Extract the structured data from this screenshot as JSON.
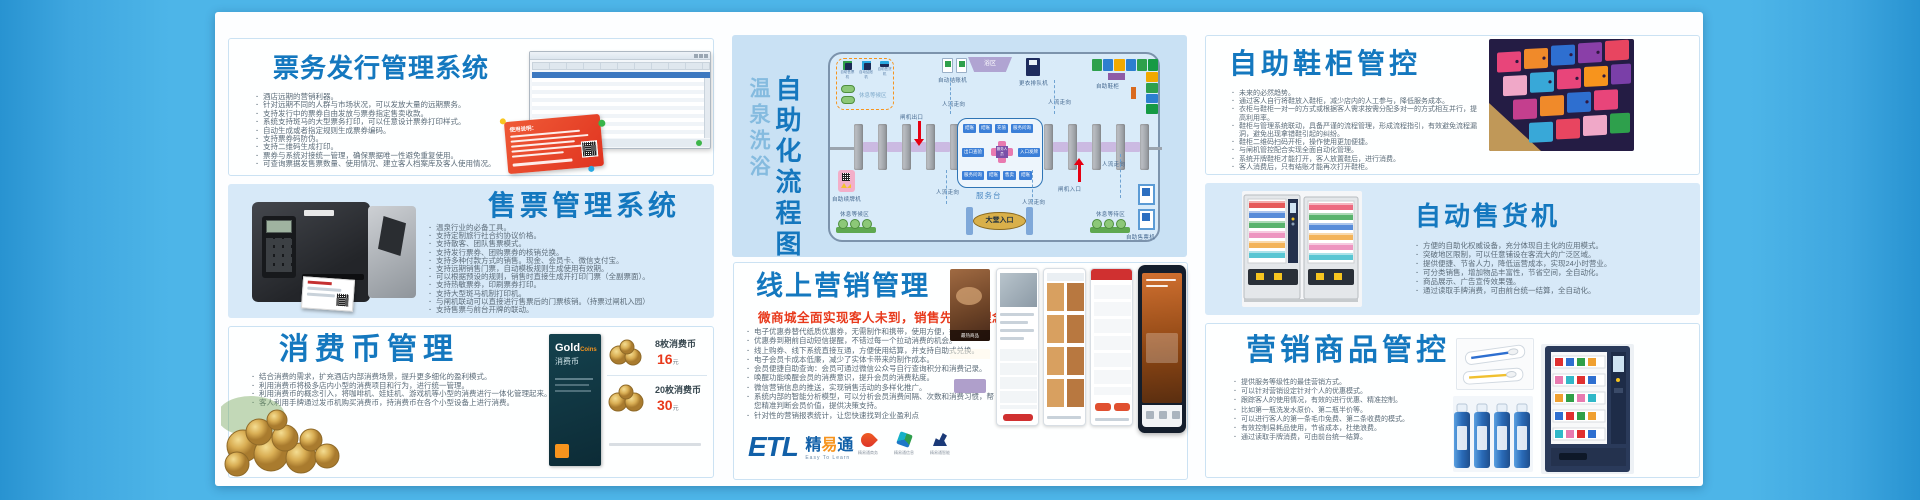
{
  "poster": {
    "ticketing": {
      "title": "票务发行管理系统",
      "card_title": "使用说明：",
      "bullets": [
        "酒店远期的营销利器。",
        "针对远期不同的人群与市场状况，可以发放大量的远期票务。",
        "支持发行中的票券自由发放与票券指定售卖收款。",
        "系统支持斑马的大型票务打印，可以任意设计票券打印样式。",
        "自动生成或者指定规则生成票券编码。",
        "支持票券码防伪。",
        "支持二维码生成打印。",
        "票券与系统对接统一管理，确保票据唯一性避免重复使用。",
        "可查询票据发售票数量、使用情况、建立客人档案库及客人使用情况。"
      ]
    },
    "selling": {
      "title": "售票管理系统",
      "bullets": [
        "温泉行业的必备工具。",
        "支持定制旅行社合约协议价格。",
        "支持散客、团队售票模式。",
        "支持发行票券、团购票券的核销兑换。",
        "支持多种付款方式的销售。现金、会员卡、微信支付宝。",
        "支持远期销售门票，自动模板规则生成使用有效期。",
        "可以根据预设的规则，销售时直接生成开打印门票（全副票面）。",
        "支持热敏票券，印刷票券打印。",
        "支持大型斑马机制打印机。",
        "与闸机联动可以直接进行售票后的门票核销。（持票过闸机入园）",
        "支持售票与前台开牌的联动。"
      ]
    },
    "coin": {
      "title": "消费币管理",
      "bullets": [
        "结合消费的需求，扩充酒店内部消费场景，提升更多细化的盈利模式。",
        "利用消费币将极多店内小型的消费项目和行为，进行统一管理。",
        "利用消费币的概念引入，将咖啡机、娃娃机、游戏机等小型的消费进行一体化管理起来。",
        "客人利用手牌通过发币机购买消费币，持消费币在各个小型设备上进行消费。"
      ],
      "card": {
        "brand": "Gold",
        "brand_sub": "Coins",
        "name": "消费币"
      },
      "prices": [
        {
          "label": "8枚消费币",
          "price": "16",
          "unit": "元"
        },
        {
          "label": "20枚消费币",
          "price": "30",
          "unit": "元"
        }
      ]
    },
    "flow": {
      "sub": "温泉洗浴",
      "main": "自助化流程图",
      "legend": [
        "自助售票机",
        "自动结账机",
        "自助售货机"
      ],
      "legend_rest": "休息等候区",
      "checkout": "自动结账机",
      "bath": "浴区",
      "queue": "更衣排队机",
      "shoe_locker": "自助鞋柜",
      "flow_dir": "人流走向",
      "gate_exit": "闸机出口",
      "gate_entry": "闸机入口",
      "desk": "服务台",
      "desk_top": [
        "结账",
        "结账",
        "充值",
        "服务问询"
      ],
      "desk_mid_left": "出口查验",
      "desk_mid_right": "入口发牌",
      "desk_center": "服务人员",
      "desk_bottom": [
        "服务问询",
        "结账",
        "售卖",
        "结账"
      ],
      "lobby": "大堂入口",
      "renew": "自助续牌机",
      "rest_left": "休息等候区",
      "rest_right": "休息等待区",
      "kiosk": "自助售票机"
    },
    "marketing": {
      "title": "线上营销管理",
      "subtitle": "微商城全面实现客人未到，销售先行的理念",
      "hot_label": "最热商品",
      "bullets": [
        "电子优惠券替代纸质优惠券，无需制作和携带，使用方便，推广迅速",
        "优惠券到期前自动短信提醒，不错过每一个拉动消费的机会。",
        "线上购券、线下系统直接互通，方便使用结算，并支持自助式兑换。",
        "电子会员卡成本低廉，减少了实体卡带来的制作成本。",
        "会员便捷自助查询：会员可通过微信公众号自行查询积分和消费记录。",
        "唤醒功能唤醒会员的消费意识，提升会员的消费粘度。",
        "微信营销信息的推送，实现销售活动的多样化推广。",
        "系统内部的智能分析模型，可以分析会员消费间隔、次数和消费习惯，帮您精准判断会员价值，提供决策支持。",
        "针对性的营销报表统计，让您快速找到企业盈利点"
      ],
      "brand": {
        "etl": "ETL",
        "cn1": "精",
        "cn2": "易",
        "cn3": "通",
        "tagline": "Easy To Learn",
        "subs": [
          "精易通商务",
          "精易通信息",
          "精易通智能"
        ]
      }
    },
    "shoe": {
      "title": "自助鞋柜管控",
      "bullets": [
        "未来的必然趋势。",
        "通过客人自行将鞋放入鞋柜，减少店内的人工参与，降低服务成本。",
        "衣柜与鞋柜一对一的方式或根据客人需求按需分配多对一的方式相互并行，提高利用率。",
        "鞋柜与管理系统联动，具备严谨的流程管理，形成流程指引，有效避免流程漏洞，避免出现拿错鞋引起的纠纷。",
        "鞋柜二维码扫码开柜，操作使用更加便捷。",
        "与闸机管控配合实现全面自动化管理。",
        "系统开牌鞋柜才能打开，客人放置鞋后，进行消费。",
        "客人消费后，只有结账才能再次打开鞋柜。"
      ]
    },
    "vending": {
      "title": "自动售货机",
      "bullets": [
        "方便的自助化权威设备，充分体现自主化的应用模式。",
        "突破地区限制，可以任意铺设在客流大的广泛区域。",
        "提供便捷、节省人力，降低运营成本，实现24小时营业。",
        "可分类销售，增加物品丰富性，节省空间，全自动化。",
        "商品展示、广告宣传效果强。",
        "通过读取手牌消费，可由前台统一结算，全自动化。"
      ]
    },
    "goods": {
      "title": "营销商品管控",
      "bullets": [
        "提供服务等级性的最佳营销方式。",
        "可以针对营销设定针对个人的优惠模式。",
        "跟踪客人的使用情况，有效的进行优惠、精准控制。",
        "比如第一瓶洗发水原价、第二瓶半价等。",
        "可以进行客人的第一条毛巾免费、第二条收费的模式。",
        "有效控制易耗品使用，节省成本，杜绝浪费。",
        "通过读取手牌消费，可由前台统一结算。"
      ]
    }
  }
}
